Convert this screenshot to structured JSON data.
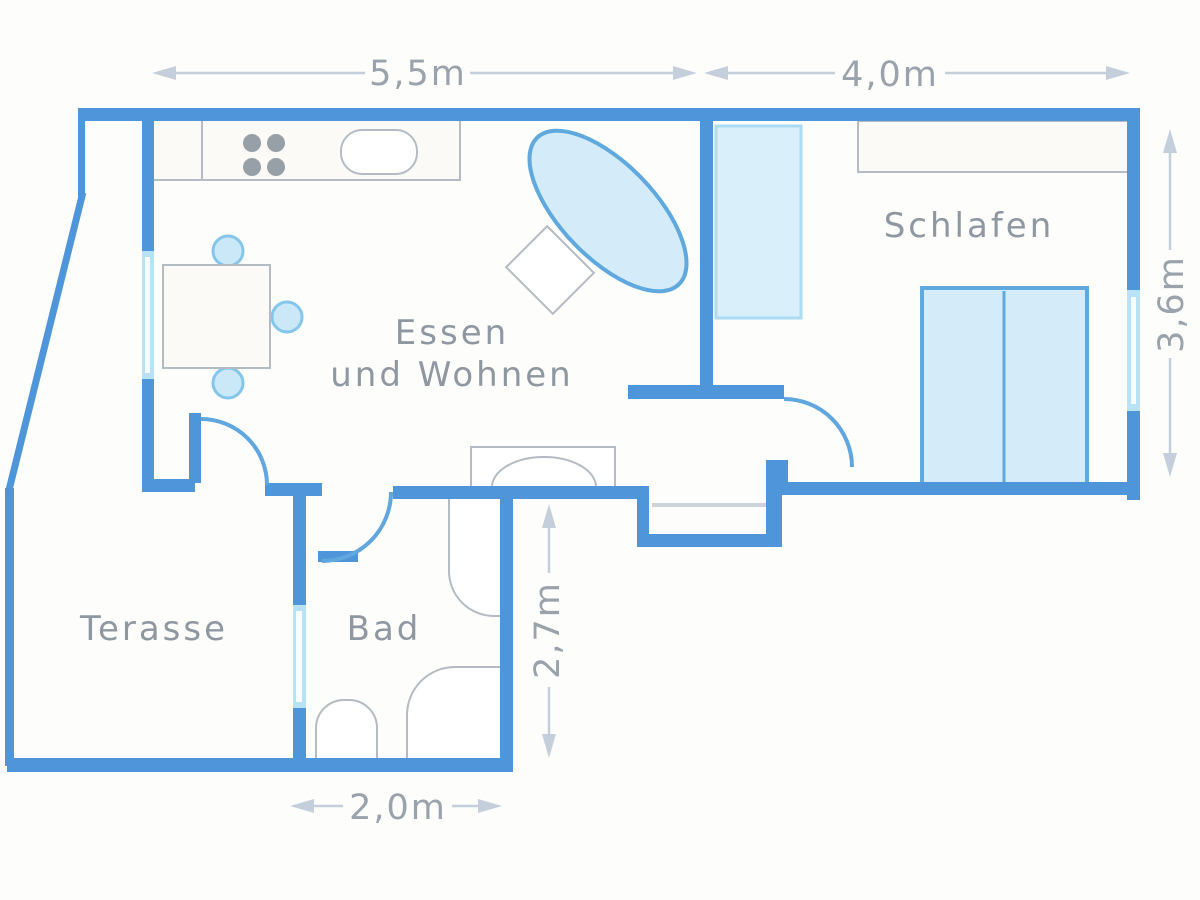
{
  "plan": {
    "type": "apartment-floor-plan",
    "rooms": {
      "living": {
        "label_line1": "Essen",
        "label_line2": "und Wohnen"
      },
      "bedroom": {
        "label": "Schlafen"
      },
      "terrace": {
        "label": "Terasse"
      },
      "bathroom": {
        "label": "Bad"
      }
    },
    "dimensions": {
      "top_left": "5,5m",
      "top_right": "4,0m",
      "right_side": "3,6m",
      "middle_vertical": "2,7m",
      "bottom": "2,0m"
    }
  },
  "colors": {
    "background": "#FDFDFB",
    "wall": "#4E95D9",
    "wall_light": "#60A6DF",
    "window": "#B8E2F5",
    "furniture_fill": "#D4EBF9",
    "furniture_stroke": "#5FA9DE",
    "outline_gray": "#B4BBC2",
    "burner": "#98A0A7",
    "label_text": "#8F97A1",
    "dim_text": "#9AA2AC",
    "dim_line": "#C5CFDB"
  }
}
